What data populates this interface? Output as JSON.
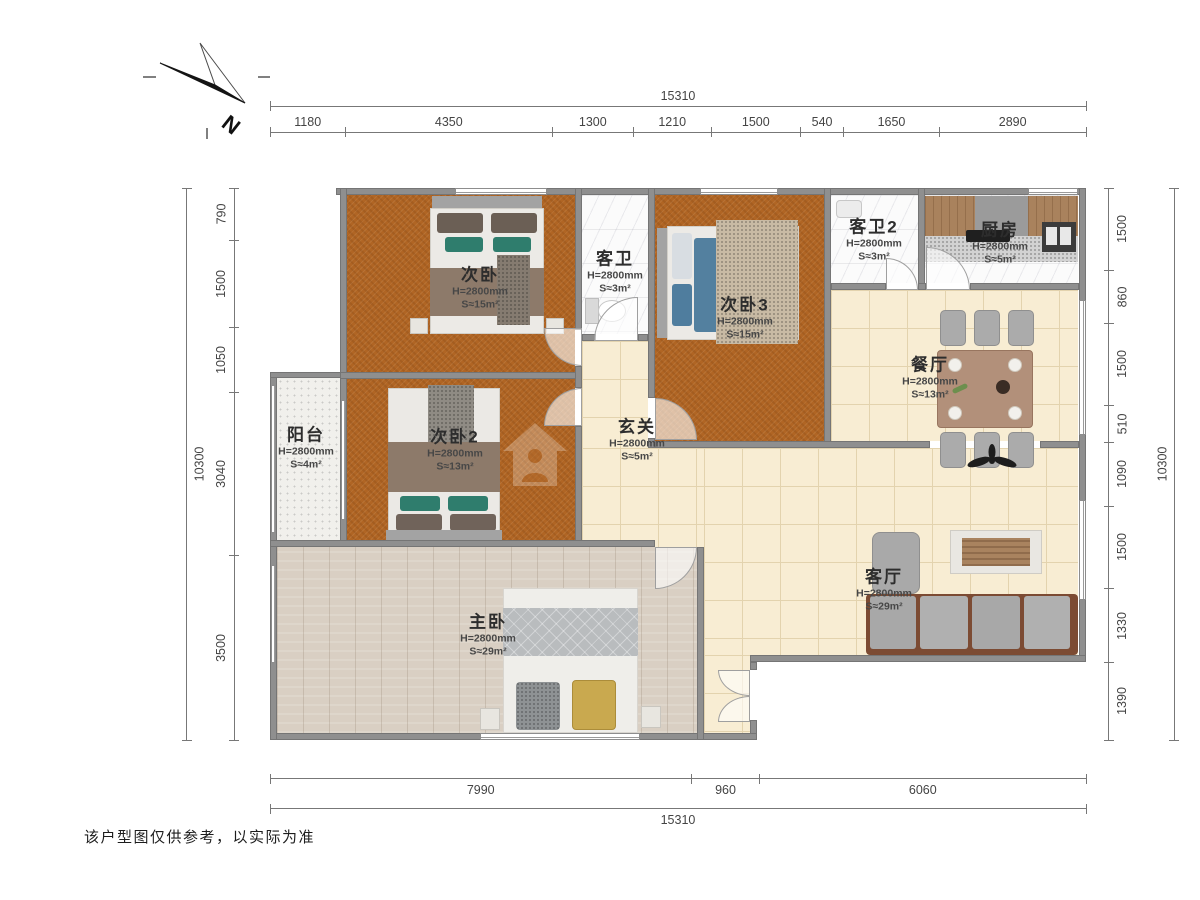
{
  "meta": {
    "compass": "N",
    "disclaimer": "该户型图仅供参考，以实际为准"
  },
  "dimensions": {
    "top": {
      "total": "15310",
      "segments": [
        "1180",
        "4350",
        "1300",
        "1210",
        "1500",
        "540",
        "1650",
        "2890"
      ]
    },
    "bottom": {
      "total": "15310",
      "segments": [
        "7990",
        "960",
        "6060"
      ]
    },
    "left": {
      "total": "10300",
      "segments": [
        "790",
        "1500",
        "1050",
        "3040",
        "3500"
      ]
    },
    "right": {
      "total": "10300",
      "segments": [
        "1500",
        "860",
        "1500",
        "510",
        "1090",
        "1500",
        "1330",
        "1390"
      ]
    }
  },
  "rooms": [
    {
      "id": "ciwo",
      "name": "次卧",
      "height": "H=2800mm",
      "area": "S≈15m²"
    },
    {
      "id": "kewei",
      "name": "客卫",
      "height": "H=2800mm",
      "area": "S≈3m²"
    },
    {
      "id": "ciwo3",
      "name": "次卧3",
      "height": "H=2800mm",
      "area": "S≈15m²"
    },
    {
      "id": "kewei2",
      "name": "客卫2",
      "height": "H=2800mm",
      "area": "S≈3m²"
    },
    {
      "id": "chufang",
      "name": "厨房",
      "height": "H=2800mm",
      "area": "S≈5m²"
    },
    {
      "id": "canting",
      "name": "餐厅",
      "height": "H=2800mm",
      "area": "S≈13m²"
    },
    {
      "id": "yangtai",
      "name": "阳台",
      "height": "H=2800mm",
      "area": "S≈4m²"
    },
    {
      "id": "ciwo2",
      "name": "次卧2",
      "height": "H=2800mm",
      "area": "S≈13m²"
    },
    {
      "id": "xuanguan",
      "name": "玄关",
      "height": "H=2800mm",
      "area": "S≈5m²"
    },
    {
      "id": "keting",
      "name": "客厅",
      "height": "H=2800mm",
      "area": "S≈29m²"
    },
    {
      "id": "zhuwo",
      "name": "主卧",
      "height": "H=2800mm",
      "area": "S≈29m²"
    }
  ],
  "colors": {
    "carpet": "#b06524",
    "tile": "#f8edd3",
    "tileLine": "#e3d3ae",
    "wood": "#d9cfc3",
    "speckle": "#f1f0ec",
    "marble": "#fbfbfb",
    "wall": "#8f8f8f",
    "teal": "#2f7d6d",
    "blanket": "#8d7a6a",
    "sofaFrame": "#7c4b33",
    "tableWood": "#b2907a",
    "text": "#3a3a3a"
  }
}
